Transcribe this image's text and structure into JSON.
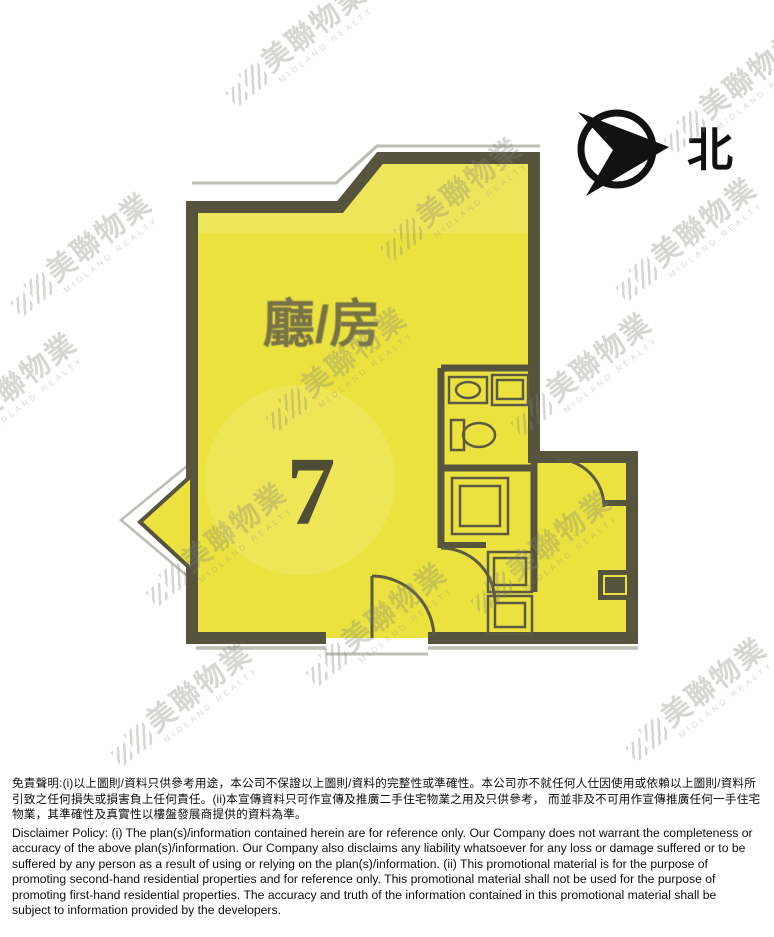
{
  "compass": {
    "north_label": "北"
  },
  "floor_plan": {
    "room_label": "廳/房",
    "unit_number": "7",
    "fill_color": "#ece23f",
    "wall_color": "#56543c"
  },
  "watermark": {
    "text": "美聯物業",
    "subtext": "MIDLAND REALTY"
  },
  "disclaimer": {
    "chinese": "免責聲明:(i)以上圖則/資料只供參考用途，本公司不保證以上圖則/資料的完整性或準確性。本公司亦不就任何人仕因使用或依賴以上圖則/資料所引致之任何損失或損害負上任何責任。(ii)本宣傳資料只可作宣傳及推廣二手住宅物業之用及只供參考， 而並非及不可用作宣傳推廣任何一手住宅物業，其準確性及真實性以樓盤發展商提供的資料為準。",
    "english": "Disclaimer Policy: (i) The plan(s)/information contained herein are for reference only. Our Company does not warrant the completeness or accuracy of the above plan(s)/information. Our Company also disclaims any liability whatsoever for any loss or damage suffered or to be suffered by any person as a result of using or relying on the plan(s)/information. (ii) This promotional material is for the purpose of promoting second-hand residential properties and for reference only. This promotional material shall not be used for the purpose of promoting first-hand residential properties. The accuracy and truth of the information contained in this promotional material shall be subject to information provided by the developers."
  }
}
